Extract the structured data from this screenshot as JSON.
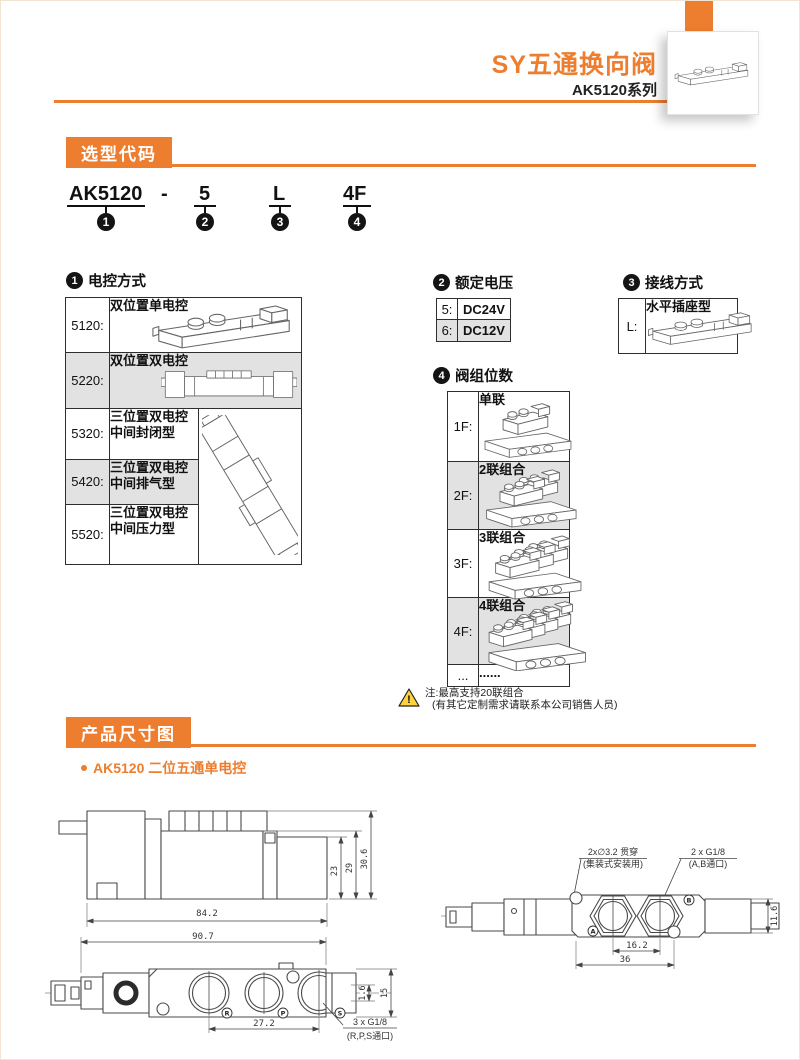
{
  "header": {
    "title": "SY五通换向阀",
    "series": "AK5120系列"
  },
  "section_selection": {
    "title": "选型代码"
  },
  "model_code": {
    "base": "AK5120",
    "dash": "-",
    "voltage": "5",
    "wiring": "L",
    "stations": "4F",
    "marker1": "1",
    "marker2": "2",
    "marker3": "3",
    "marker4": "4"
  },
  "table_control": {
    "number": "1",
    "title": "电控方式",
    "rows": [
      {
        "code": "5120:",
        "desc": "双位置单电控"
      },
      {
        "code": "5220:",
        "desc": "双位置双电控"
      },
      {
        "code": "5320:",
        "desc1": "三位置双电控",
        "desc2": "中间封闭型"
      },
      {
        "code": "5420:",
        "desc1": "三位置双电控",
        "desc2": "中间排气型"
      },
      {
        "code": "5520:",
        "desc1": "三位置双电控",
        "desc2": "中间压力型"
      }
    ]
  },
  "table_voltage": {
    "number": "2",
    "title": "额定电压",
    "rows": [
      {
        "code": "5:",
        "value": "DC24V"
      },
      {
        "code": "6:",
        "value": "DC12V"
      }
    ]
  },
  "table_wiring": {
    "number": "3",
    "title": "接线方式",
    "rows": [
      {
        "code": "L:",
        "value": "水平插座型"
      }
    ]
  },
  "table_stations": {
    "number": "4",
    "title": "阀组位数",
    "rows": [
      {
        "code": "1F:",
        "desc": "单联"
      },
      {
        "code": "2F:",
        "desc": "2联组合"
      },
      {
        "code": "3F:",
        "desc": "3联组合"
      },
      {
        "code": "4F:",
        "desc": "4联组合"
      },
      {
        "code": "...",
        "desc": "......"
      }
    ]
  },
  "note": {
    "line1": "注:最高支持20联组合",
    "line2": "(有其它定制需求请联系本公司销售人员)"
  },
  "section_dimensions": {
    "title": "产品尺寸图",
    "subtitle": "AK5120 二位五通单电控"
  },
  "drawing_side": {
    "dim_length": "84.2",
    "dim_h1": "23",
    "dim_h2": "29",
    "dim_h3": "30.6"
  },
  "drawing_top": {
    "label_hole1": "2x∅3.2 贯穿",
    "label_hole2": "(集装式安装用)",
    "label_port1": "2 x G1/8",
    "label_port2": "(A,B通口)",
    "dim_pitch": "16.2",
    "dim_span": "36",
    "dim_height": "11.6",
    "port_a": "A",
    "port_b": "B"
  },
  "drawing_bottom": {
    "dim_length": "90.7",
    "dim_pitch": "27.2",
    "label_port1": "3 x G1/8",
    "label_port2": "(R,P,S通口)",
    "dim_offset": "1.6",
    "dim_height": "15",
    "port_r": "R",
    "port_p": "P",
    "port_s": "S"
  },
  "colors": {
    "accent": "#ED7D2F",
    "row_gray": "#E2E2E2",
    "warning_yellow": "#FFD43B"
  }
}
